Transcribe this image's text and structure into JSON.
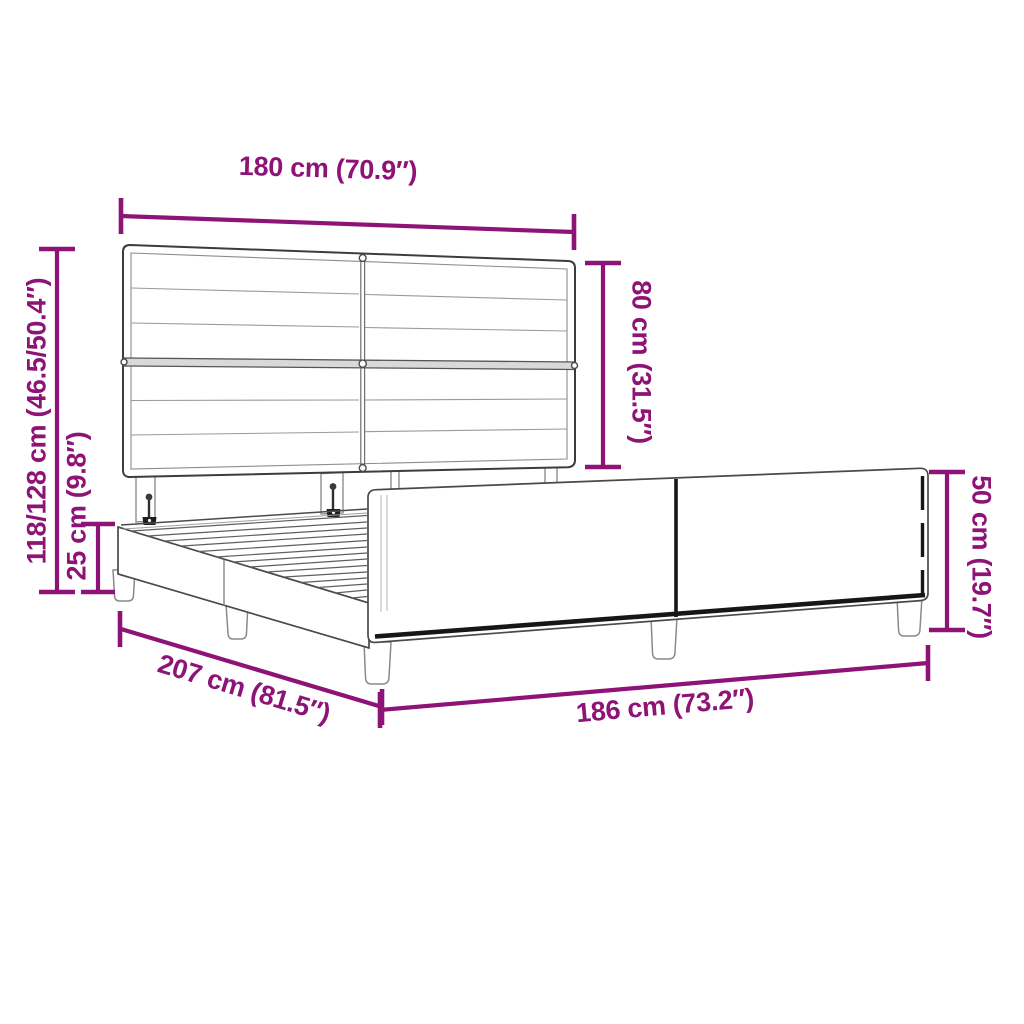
{
  "diagram": {
    "kind": "product dimension diagram",
    "product": "Upholstered bed frame with panel headboard and slatted base",
    "background": "#ffffff"
  },
  "colors": {
    "dimension_annotation": "#8E1377",
    "drawing_outline": "#4a4a4a",
    "drawing_detail": "#999999",
    "shadow_black": "#1a1a1a"
  },
  "measurements": {
    "headboard_width": {
      "label": "180 cm (70.9″)",
      "cm": "180",
      "inch": "70.9"
    },
    "headboard_height": {
      "label": "80 cm (31.5″)",
      "cm": "80",
      "inch": "31.5"
    },
    "total_height": {
      "label": "118/128 cm (46.5/50.4″)",
      "cm": "118/128",
      "inch": "46.5/50.4"
    },
    "base_height": {
      "label": "25 cm (9.8″)",
      "cm": "25",
      "inch": "9.8"
    },
    "frame_length": {
      "label": "207 cm (81.5″)",
      "cm": "207",
      "inch": "81.5"
    },
    "frame_width": {
      "label": "186 cm (73.2″)",
      "cm": "186",
      "inch": "73.2"
    },
    "footboard_height": {
      "label": "50 cm (19.7″)",
      "cm": "50",
      "inch": "19.7"
    }
  }
}
